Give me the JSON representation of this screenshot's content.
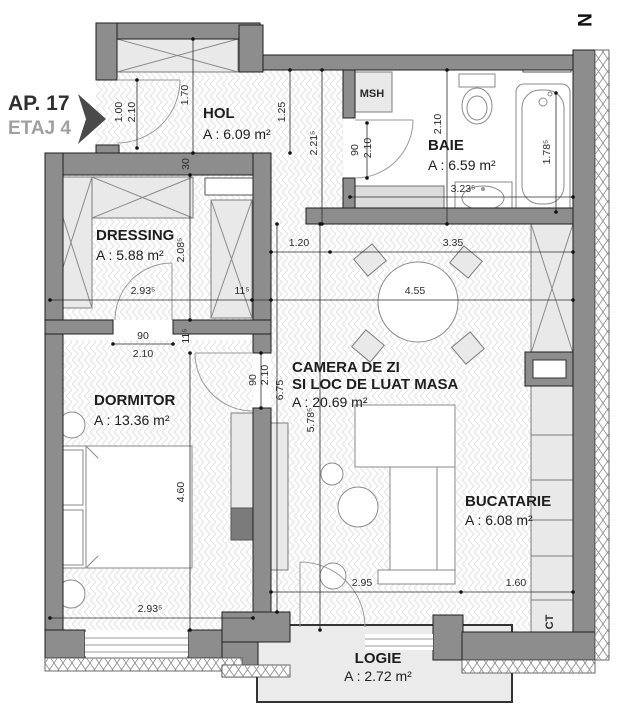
{
  "header": {
    "apartment": "AP. 17",
    "floor": "ETAJ 4",
    "north": "N"
  },
  "rooms": {
    "hol": {
      "name": "HOL",
      "area": "A : 6.09 m²"
    },
    "baie": {
      "name": "BAIE",
      "area": "A : 6.59 m²"
    },
    "dressing": {
      "name": "DRESSING",
      "area": "A : 5.88 m²"
    },
    "dormitor": {
      "name": "DORMITOR",
      "area": "A : 13.36 m²"
    },
    "camera": {
      "name": "CAMERA DE ZI",
      "name2": "SI LOC DE LUAT MASA",
      "area": "A : 20.69 m²"
    },
    "bucatarie": {
      "name": "BUCATARIE",
      "area": "A : 6.08 m²"
    },
    "logie": {
      "name": "LOGIE",
      "area": "A : 2.72 m²"
    }
  },
  "labels": {
    "washing_machine": "MSH",
    "boiler": "CT"
  },
  "dims": {
    "entry_door_w": "1.00",
    "entry_door_h": "2.10",
    "hol_depth": "1.70",
    "hol_width": "1.25",
    "hall_height": "2.21⁵",
    "bath_door_w": "90",
    "bath_door_h": "2.10",
    "bath_depth": "2.10",
    "bath_width": "3.23⁵",
    "tub_length": "1.78⁵",
    "wall_30": "30",
    "dressing_depth": "2.08⁵",
    "dressing_width": "2.93⁵",
    "wall_115_a": "11⁵",
    "dressing_door_w": "90",
    "dressing_door_h": "2.10",
    "wall_115_b": "11⁵",
    "bedroom_door_w": "90",
    "bedroom_door_h": "2.10",
    "living_depth": "6.75",
    "living_depth2": "5.78⁵",
    "living_seg1": "1.20",
    "living_seg2": "3.35",
    "living_width": "4.55",
    "bedroom_depth": "4.60",
    "living_bottom_w": "2.95",
    "kitchen_w": "1.60",
    "bedroom_width": "2.93⁵"
  },
  "colors": {
    "wall": "#8d8d8d",
    "furniture": "#e9e9e9",
    "text": "#1d1d1d",
    "floor_accent": "#a0a0a0"
  }
}
